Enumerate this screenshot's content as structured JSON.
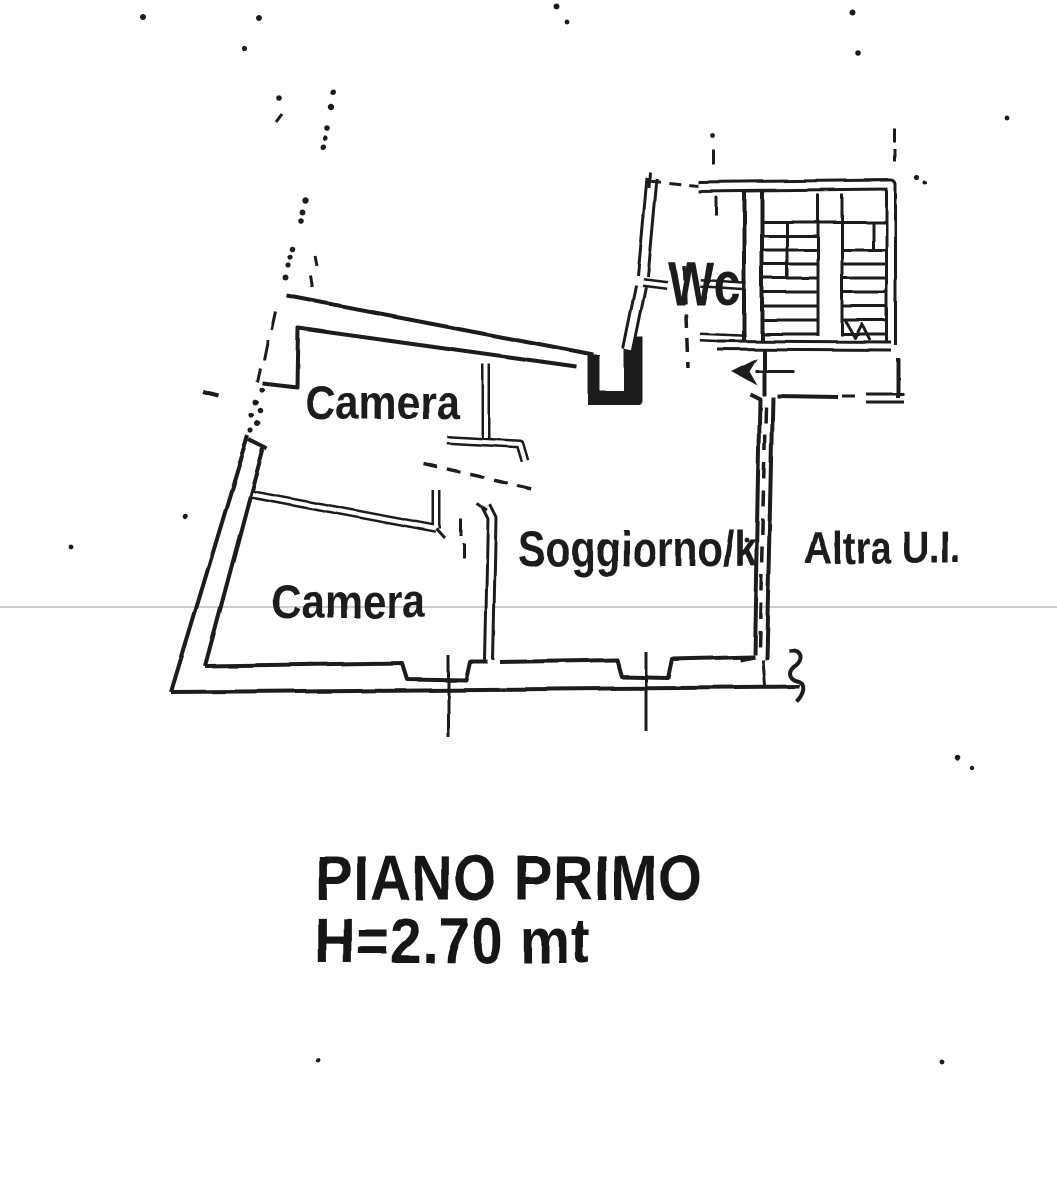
{
  "floor_plan": {
    "labels": {
      "camera_top": "Camera",
      "camera_bottom": "Camera",
      "soggiorno": "Soggiorno/k",
      "altra_ui": "Altra U.I.",
      "wc": "Wc"
    },
    "title": {
      "line1": "PIANO PRIMO",
      "line2": "H=2.70 mt"
    },
    "colors": {
      "ink": "#1c1c1c",
      "paper": "#ffffff",
      "faint_scan_line": "#cccccc"
    },
    "features": {
      "stair_arrow": "stair-direction-arrow",
      "stair": "staircase-with-central-stringer",
      "boundary": "dash-dot-property-line"
    }
  }
}
